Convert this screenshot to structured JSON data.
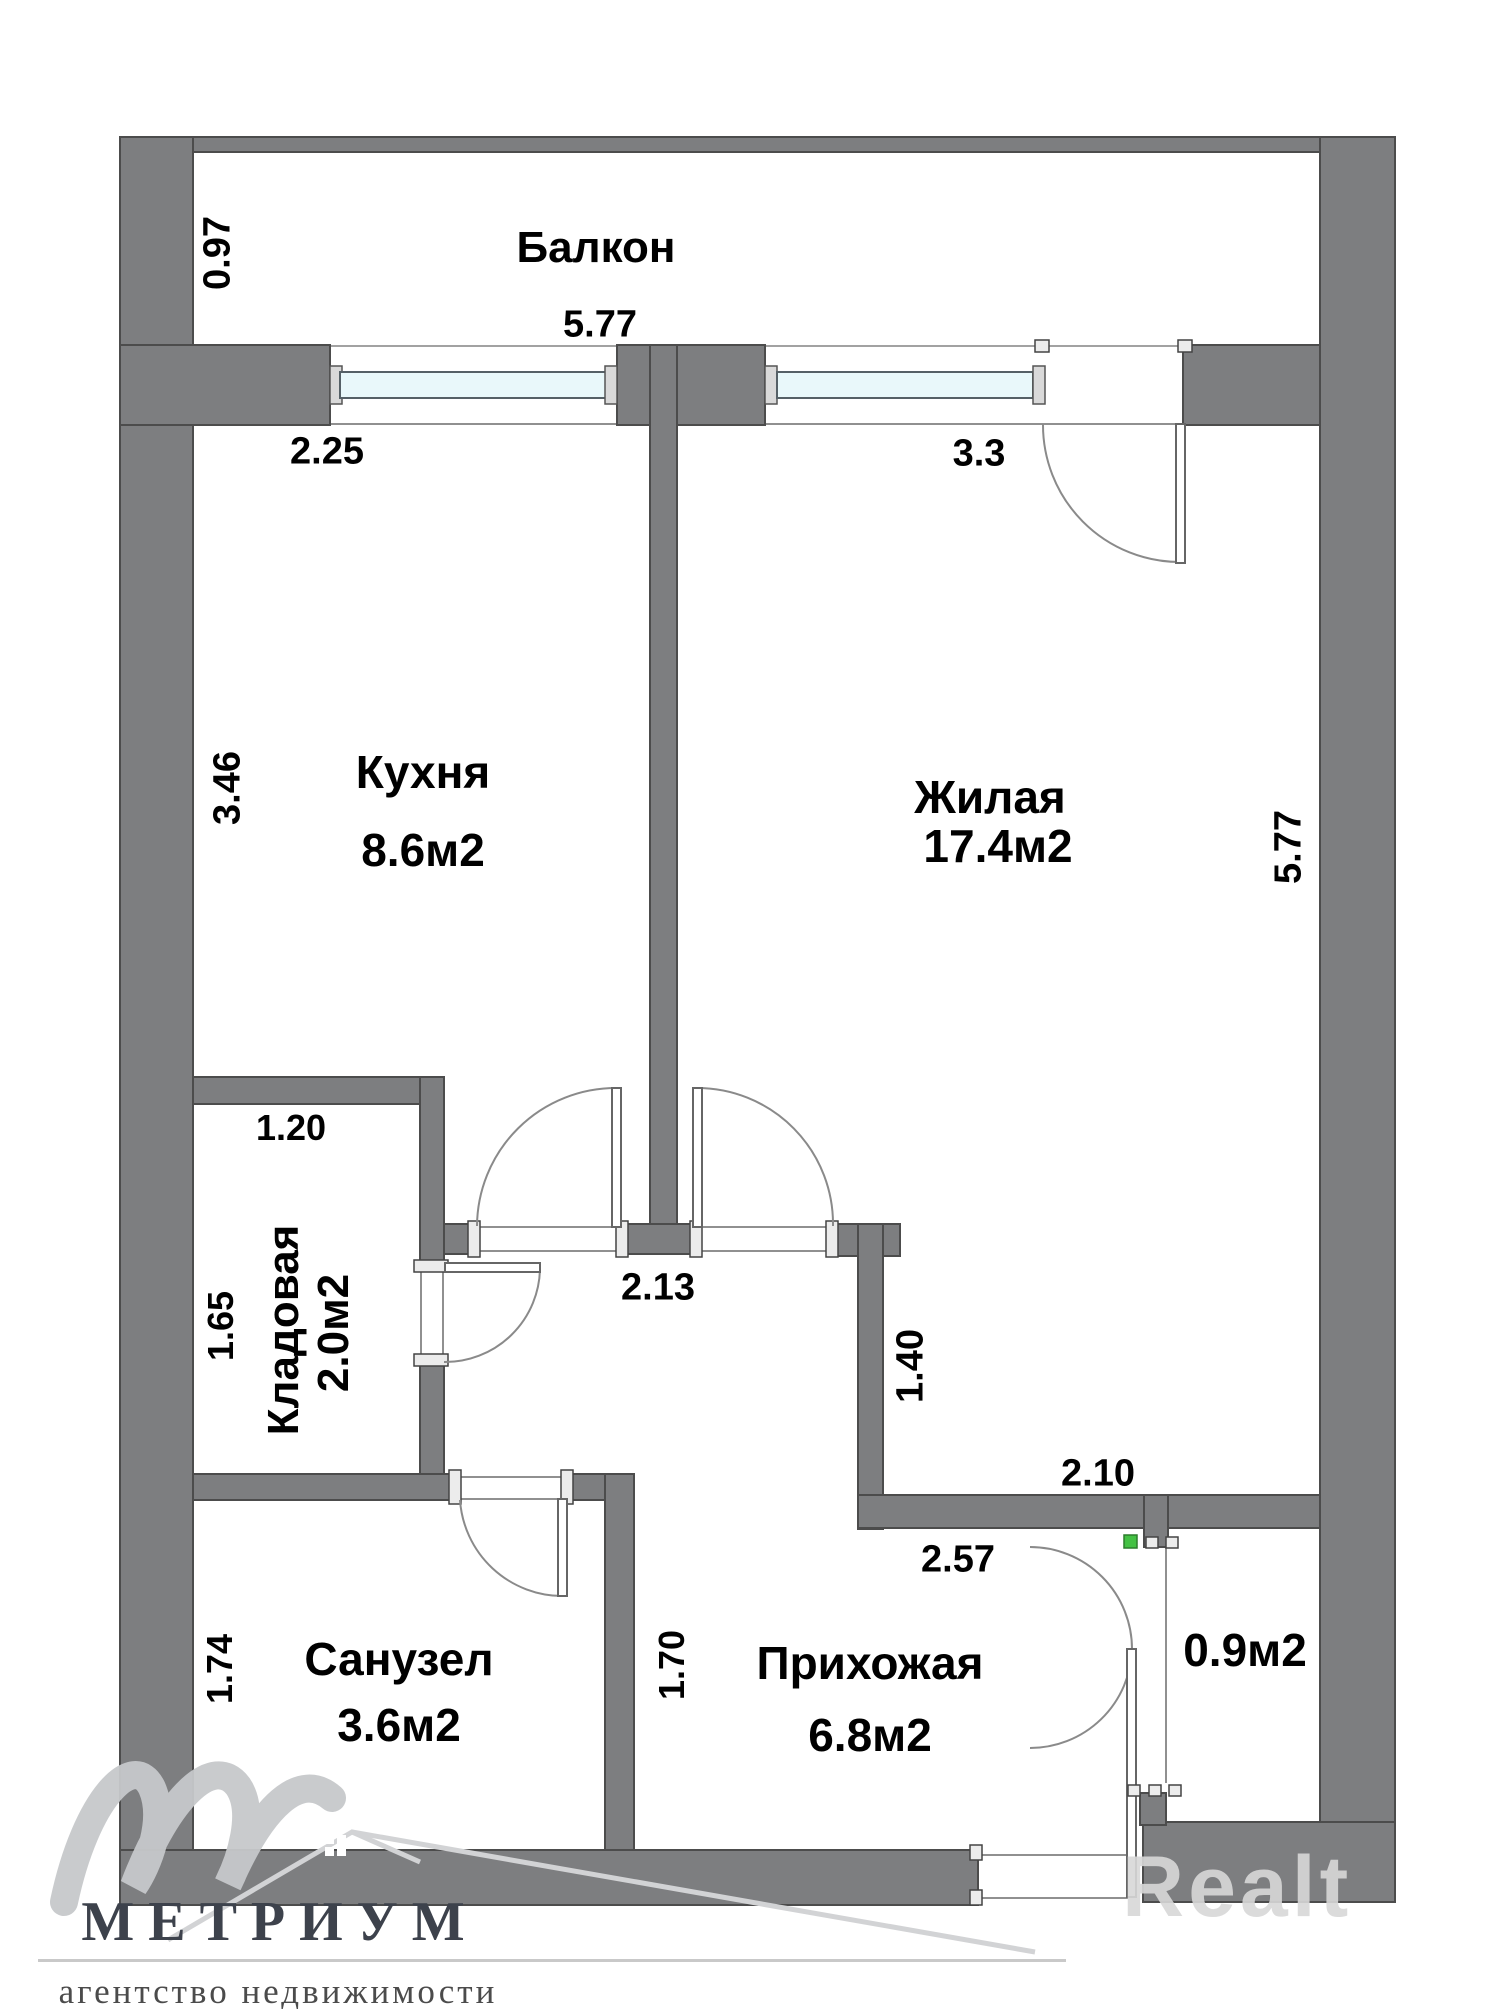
{
  "branding": {
    "agency_name": "МЕТРИУМ",
    "agency_subtitle": "агентство недвижимости",
    "watermark": "Realt"
  },
  "rooms": {
    "balcony": {
      "name": "Балкон"
    },
    "kitchen": {
      "name": "Кухня",
      "area": "8.6м2"
    },
    "living_room": {
      "name": "Жилая",
      "area": "17.4м2"
    },
    "storage": {
      "name": "Кладовая",
      "area": "2.0м2"
    },
    "bathroom": {
      "name": "Санузел",
      "area": "3.6м2"
    },
    "hallway": {
      "name": "Прихожая",
      "area": "6.8м2"
    },
    "vestibule": {
      "area": "0.9м2"
    }
  },
  "dimensions": {
    "balcony_depth": "0.97",
    "balcony_length": "5.77",
    "kitchen_window_width": "2.25",
    "kitchen_depth": "3.46",
    "living_window_wall": "3.3",
    "living_length": "5.77",
    "storage_width": "1.20",
    "storage_depth": "1.65",
    "corridor_opening": "2.13",
    "living_lower_wall": "1.40",
    "hall_upper_wall": "2.10",
    "hall_width": "2.57",
    "bathroom_depth": "1.74",
    "hall_left_wall": "1.70"
  },
  "colors": {
    "wall": "#7d7e80",
    "wall_outline": "#4c4c4c",
    "glass": "#e9f8fa",
    "marker_green": "#44c144",
    "watermark_gray": "#d8d8d8",
    "logo_text": "#3d424c"
  }
}
